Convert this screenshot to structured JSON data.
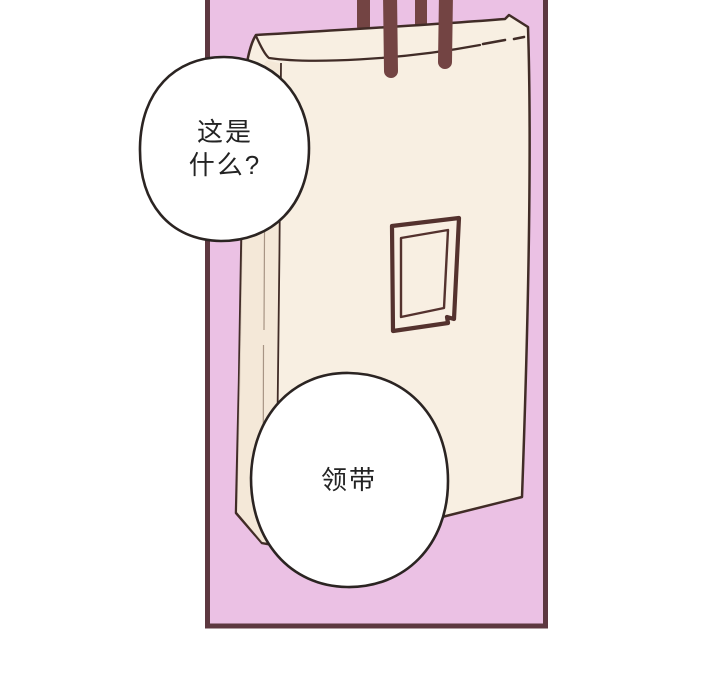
{
  "colors": {
    "page_background": "#ffffff",
    "panel_background": "#ebc1e4",
    "panel_border": "#5d3840",
    "bag_fill": "#f8efe2",
    "bag_side_shade": "#f3e6d6",
    "bag_outline": "#412c27",
    "handle": "#734443",
    "tag_outline": "#54322e",
    "bubble_fill": "#ffffff",
    "bubble_outline": "#2b2422",
    "text": "#232323"
  },
  "speech": {
    "question_bubble": {
      "line1": "这是",
      "line2": "什么?"
    },
    "answer_bubble": {
      "line1": "领带"
    }
  }
}
